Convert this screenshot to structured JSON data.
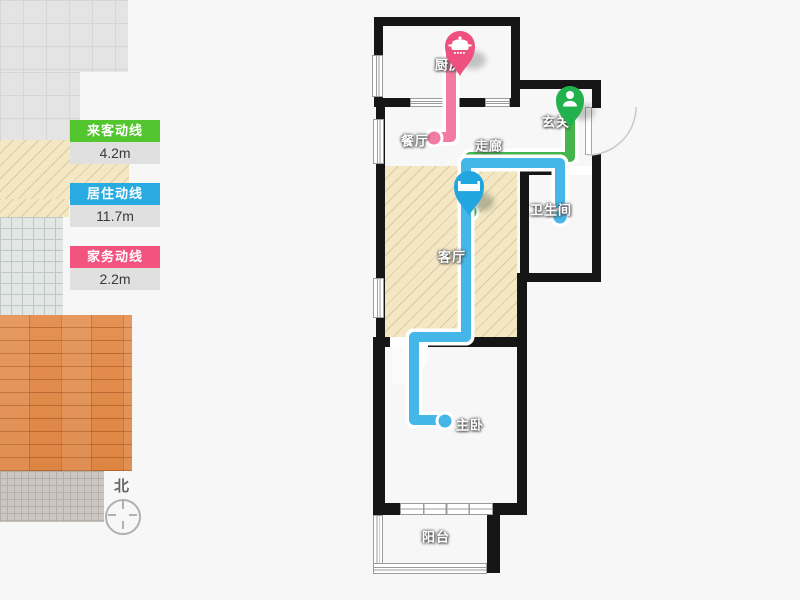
{
  "legend": {
    "items": [
      {
        "label": "来客动线",
        "value": "4.2m",
        "color": "#53c52f"
      },
      {
        "label": "居住动线",
        "value": "11.7m",
        "color": "#29aae1"
      },
      {
        "label": "家务动线",
        "value": "2.2m",
        "color": "#f2537f"
      }
    ]
  },
  "compass": {
    "label": "北"
  },
  "rooms": {
    "kitchen": {
      "label": "厨房"
    },
    "dining": {
      "label": "餐厅"
    },
    "corridor": {
      "label": "走廊"
    },
    "entry": {
      "label": "玄关"
    },
    "bathroom": {
      "label": "卫生间"
    },
    "living": {
      "label": "客厅"
    },
    "bedroom": {
      "label": "主卧"
    },
    "balcony": {
      "label": "阳台"
    }
  },
  "flow_lines": [
    {
      "id": "guest-line",
      "color": "#43b54b",
      "from": "玄关",
      "to": "客厅"
    },
    {
      "id": "resident-line",
      "color": "#45b6e8",
      "from": "卫生间",
      "to": "主卧"
    },
    {
      "id": "housework-line",
      "color": "#f27ca1",
      "from": "厨房",
      "to": "餐厅"
    }
  ],
  "pins": [
    {
      "id": "kitchen-pin",
      "icon": "pot-icon",
      "color": "#f0507e"
    },
    {
      "id": "entry-pin",
      "icon": "person-icon",
      "color": "#22b14c"
    },
    {
      "id": "living-pin",
      "icon": "bed-icon",
      "color": "#21a6e0"
    }
  ]
}
